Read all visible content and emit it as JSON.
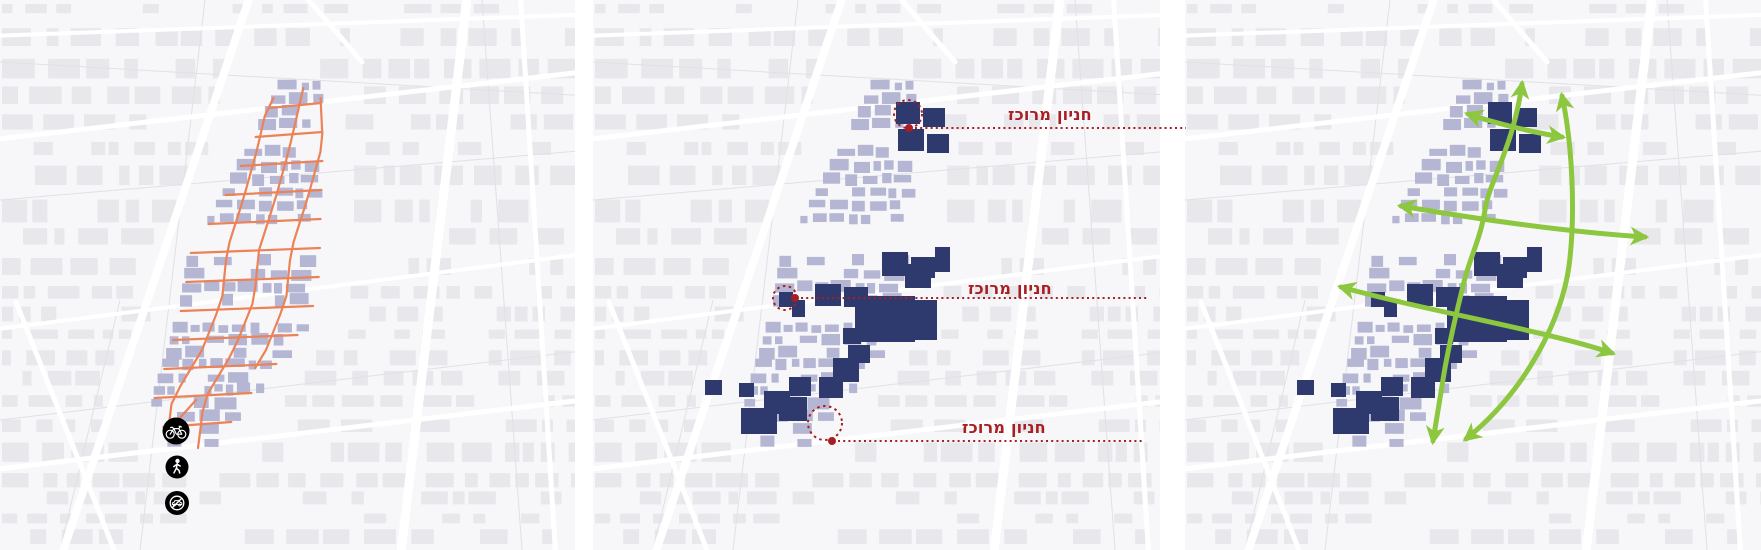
{
  "diagram": {
    "kind": "three-panel urban design diagram",
    "panel_count": 3
  },
  "colors": {
    "page_background": "#ffffff",
    "basemap_background": "#f7f7f9",
    "basemap_building": "#e8e8ec",
    "basemap_road": "#ffffff",
    "basemap_road_faint": "#e0e0e6",
    "district_building": "#b4b6d3",
    "highlight_building": "#2e3a6e",
    "street_overlay": "#ec8257",
    "icon_background": "#ef8355",
    "icon_glyph": "#ffffff",
    "annotation": "#a81e22",
    "arrow": "#8dc63f"
  },
  "panels": [
    {
      "name": "pedestrian-bike-street-network",
      "icons": [
        {
          "name": "bicycle-icon"
        },
        {
          "name": "pedestrian-icon"
        },
        {
          "name": "no-private-cars-icon"
        }
      ]
    },
    {
      "name": "centralized-parking",
      "labels": [
        {
          "text": "חניון מרוכז"
        },
        {
          "text": "חניון מרוכז"
        },
        {
          "text": "חניון מרוכז"
        }
      ]
    },
    {
      "name": "circulation-arrows"
    }
  ]
}
